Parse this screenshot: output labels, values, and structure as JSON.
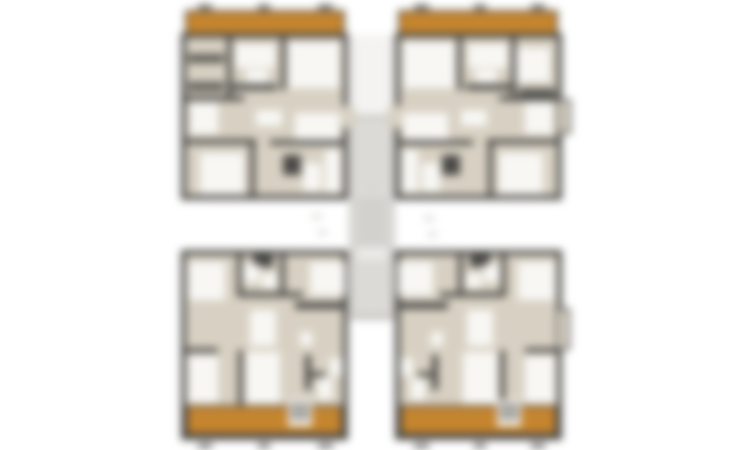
{
  "meta": {
    "description": "Blurred architectural floor plan: four apartment units around a central stair core, orange balconies on outer edges"
  },
  "floorplan": {
    "canvas": {
      "width": 750,
      "height": 450,
      "background": "#ffffff"
    },
    "palette": {
      "wall": "#4a4946",
      "floor": "#d8d1c3",
      "room": "#f8f7f4",
      "balcony": "#c5852f",
      "core": "#dcdad6",
      "coreLine": "#c3c1bd",
      "furn": "#5f5d58",
      "faint": "#e3e1de"
    },
    "shapes": [
      [
        350,
        35,
        44,
        80,
        "#f4f3f1",
        "corridor-upper",
        0
      ],
      [
        352,
        35,
        2,
        80,
        "faint",
        "corridor-wall-line",
        0
      ],
      [
        390,
        35,
        2,
        80,
        "faint",
        "corridor-wall-line",
        0
      ],
      [
        349,
        115,
        46,
        205,
        "core",
        "stair-core",
        0
      ],
      [
        352,
        115,
        40,
        3,
        "coreLine",
        "core-edge",
        0
      ],
      [
        351,
        118,
        2,
        198,
        "coreLine",
        "core-edge",
        0
      ],
      [
        391,
        118,
        2,
        198,
        "coreLine",
        "core-edge",
        0
      ],
      [
        358,
        200,
        28,
        3,
        "coreLine",
        "stair-tread",
        0
      ],
      [
        358,
        208,
        28,
        3,
        "coreLine",
        "stair-tread",
        0
      ],
      [
        358,
        216,
        28,
        3,
        "coreLine",
        "stair-tread",
        0
      ],
      [
        358,
        224,
        28,
        3,
        "coreLine",
        "stair-tread",
        0
      ],
      [
        358,
        232,
        28,
        3,
        "coreLine",
        "stair-tread",
        0
      ],
      [
        358,
        240,
        28,
        3,
        "coreLine",
        "stair-tread",
        0
      ],
      [
        357,
        248,
        30,
        12,
        "#eceae7",
        "stair-landing",
        0
      ],
      [
        352,
        316,
        40,
        3,
        "#b3b1ad",
        "core-edge",
        0
      ],
      [
        312,
        214,
        10,
        5,
        "#dddbd8",
        "faint-annotation",
        0
      ],
      [
        318,
        230,
        9,
        5,
        "#dddbd8",
        "faint-annotation",
        0
      ],
      [
        424,
        216,
        10,
        5,
        "#dddbd8",
        "faint-annotation",
        0
      ],
      [
        428,
        232,
        9,
        5,
        "#dddbd8",
        "faint-annotation",
        0
      ],
      [
        366,
        184,
        12,
        5,
        "#d6d4d1",
        "faint-annotation",
        0
      ],
      [
        198,
        5,
        14,
        4,
        "wall",
        "dimension-tick",
        0
      ],
      [
        258,
        5,
        12,
        4,
        "wall",
        "dimension-tick",
        0
      ],
      [
        318,
        5,
        15,
        4,
        "wall",
        "dimension-tick",
        0
      ],
      [
        185,
        10,
        160,
        25,
        "balcony",
        "balcony-top-left",
        1
      ],
      [
        181,
        33,
        167,
        167,
        "wall",
        "unit-a-outline",
        0
      ],
      [
        186,
        38,
        157,
        157,
        "floor",
        "unit-a-floor",
        0
      ],
      [
        227,
        38,
        5,
        60,
        "wall",
        "wall-segment",
        0
      ],
      [
        188,
        54,
        36,
        9,
        "furn",
        "furniture",
        0
      ],
      [
        188,
        82,
        36,
        9,
        "furn",
        "furniture",
        0
      ],
      [
        235,
        44,
        40,
        24,
        "room",
        "room-area",
        0
      ],
      [
        246,
        70,
        22,
        13,
        "room",
        "room-area",
        0
      ],
      [
        281,
        38,
        5,
        52,
        "wall",
        "wall-segment",
        0
      ],
      [
        227,
        84,
        50,
        6,
        "wall",
        "wall-segment",
        0
      ],
      [
        288,
        42,
        52,
        46,
        "room",
        "room-area",
        0
      ],
      [
        186,
        96,
        58,
        5,
        "wall",
        "wall-segment",
        0
      ],
      [
        190,
        102,
        28,
        32,
        "room",
        "room-area",
        0
      ],
      [
        256,
        110,
        26,
        16,
        "room",
        "room-area",
        0
      ],
      [
        295,
        113,
        45,
        32,
        "room",
        "room-area",
        0
      ],
      [
        186,
        139,
        70,
        5,
        "wall",
        "wall-segment",
        0
      ],
      [
        270,
        140,
        73,
        5,
        "wall",
        "wall-segment",
        0
      ],
      [
        250,
        144,
        5,
        51,
        "wall",
        "wall-segment",
        0
      ],
      [
        200,
        153,
        44,
        41,
        "room",
        "room-area",
        0
      ],
      [
        283,
        155,
        18,
        20,
        "wall",
        "wall-segment",
        0
      ],
      [
        303,
        163,
        18,
        28,
        "room",
        "room-area",
        0
      ],
      [
        325,
        150,
        16,
        42,
        "room",
        "room-area",
        0
      ],
      [
        343,
        106,
        12,
        22,
        "floor",
        "door-opening",
        0
      ],
      [
        414,
        5,
        15,
        4,
        "wall",
        "dimension-tick",
        0
      ],
      [
        474,
        5,
        12,
        4,
        "wall",
        "dimension-tick",
        0
      ],
      [
        531,
        5,
        14,
        4,
        "wall",
        "dimension-tick",
        0
      ],
      [
        398,
        10,
        160,
        25,
        "balcony",
        "balcony-top-right",
        1
      ],
      [
        395,
        33,
        167,
        167,
        "wall",
        "unit-b-outline",
        0
      ],
      [
        400,
        38,
        157,
        157,
        "floor",
        "unit-b-floor",
        0
      ],
      [
        557,
        99,
        14,
        35,
        "floor",
        "bay-window",
        1
      ],
      [
        511,
        38,
        5,
        60,
        "wall",
        "wall-segment",
        0
      ],
      [
        516,
        48,
        34,
        34,
        "room",
        "room-area",
        0
      ],
      [
        519,
        88,
        36,
        8,
        "furn",
        "furniture",
        0
      ],
      [
        468,
        44,
        40,
        24,
        "room",
        "room-area",
        0
      ],
      [
        475,
        70,
        22,
        13,
        "room",
        "room-area",
        0
      ],
      [
        457,
        38,
        5,
        52,
        "wall",
        "wall-segment",
        0
      ],
      [
        466,
        84,
        50,
        6,
        "wall",
        "wall-segment",
        0
      ],
      [
        403,
        42,
        52,
        46,
        "room",
        "room-area",
        0
      ],
      [
        499,
        96,
        58,
        5,
        "wall",
        "wall-segment",
        0
      ],
      [
        525,
        102,
        28,
        32,
        "room",
        "room-area",
        0
      ],
      [
        461,
        110,
        26,
        16,
        "room",
        "room-area",
        0
      ],
      [
        403,
        113,
        45,
        32,
        "room",
        "room-area",
        0
      ],
      [
        487,
        139,
        70,
        5,
        "wall",
        "wall-segment",
        0
      ],
      [
        400,
        140,
        73,
        5,
        "wall",
        "wall-segment",
        0
      ],
      [
        488,
        144,
        5,
        51,
        "wall",
        "wall-segment",
        0
      ],
      [
        499,
        153,
        44,
        41,
        "room",
        "room-area",
        0
      ],
      [
        442,
        155,
        18,
        20,
        "wall",
        "wall-segment",
        0
      ],
      [
        422,
        163,
        18,
        28,
        "room",
        "room-area",
        0
      ],
      [
        402,
        150,
        16,
        42,
        "room",
        "room-area",
        0
      ],
      [
        388,
        106,
        12,
        22,
        "floor",
        "door-opening",
        0
      ],
      [
        181,
        250,
        167,
        190,
        "wall",
        "unit-c-outline",
        0
      ],
      [
        186,
        255,
        157,
        150,
        "floor",
        "unit-c-floor",
        0
      ],
      [
        186,
        405,
        157,
        30,
        "balcony",
        "balcony-bottom-left",
        1
      ],
      [
        188,
        262,
        37,
        38,
        "room",
        "room-area",
        0
      ],
      [
        237,
        255,
        5,
        40,
        "wall",
        "wall-segment",
        0
      ],
      [
        280,
        255,
        5,
        40,
        "wall",
        "wall-segment",
        0
      ],
      [
        253,
        255,
        20,
        12,
        "wall",
        "wall-segment",
        0
      ],
      [
        243,
        264,
        16,
        18,
        "room",
        "room-area",
        0
      ],
      [
        262,
        273,
        15,
        15,
        "room",
        "room-area",
        0
      ],
      [
        237,
        292,
        66,
        5,
        "wall",
        "wall-segment",
        0
      ],
      [
        310,
        262,
        35,
        33,
        "room",
        "room-area",
        0
      ],
      [
        295,
        302,
        50,
        7,
        "wall",
        "wall-segment",
        0
      ],
      [
        250,
        310,
        26,
        36,
        "room",
        "room-area",
        0
      ],
      [
        300,
        332,
        12,
        14,
        "room",
        "room-area",
        0
      ],
      [
        186,
        348,
        32,
        5,
        "wall",
        "wall-segment",
        0
      ],
      [
        238,
        350,
        5,
        55,
        "wall",
        "wall-segment",
        0
      ],
      [
        188,
        355,
        30,
        48,
        "room",
        "room-area",
        0
      ],
      [
        246,
        352,
        34,
        52,
        "room",
        "room-area",
        0
      ],
      [
        305,
        355,
        6,
        35,
        "wall",
        "wall-segment",
        0
      ],
      [
        311,
        372,
        14,
        5,
        "wall",
        "wall-segment",
        0
      ],
      [
        318,
        378,
        14,
        22,
        "room",
        "room-area",
        0
      ],
      [
        330,
        358,
        13,
        18,
        "room",
        "room-area",
        0
      ],
      [
        288,
        400,
        24,
        26,
        "room",
        "balcony-steps",
        0
      ],
      [
        290,
        404,
        20,
        3,
        "furn",
        "step-tread",
        0
      ],
      [
        290,
        410,
        20,
        3,
        "furn",
        "step-tread",
        0
      ],
      [
        290,
        416,
        20,
        3,
        "furn",
        "step-tread",
        0
      ],
      [
        198,
        444,
        14,
        4,
        "wall",
        "dimension-tick",
        0
      ],
      [
        258,
        444,
        12,
        4,
        "wall",
        "dimension-tick",
        0
      ],
      [
        318,
        444,
        15,
        4,
        "wall",
        "dimension-tick",
        0
      ],
      [
        395,
        250,
        167,
        190,
        "wall",
        "unit-d-outline",
        0
      ],
      [
        400,
        255,
        157,
        150,
        "floor",
        "unit-d-floor",
        0
      ],
      [
        400,
        405,
        157,
        30,
        "balcony",
        "balcony-bottom-right",
        1
      ],
      [
        556,
        308,
        14,
        42,
        "floor",
        "bay-window",
        1
      ],
      [
        518,
        262,
        37,
        38,
        "room",
        "room-area",
        0
      ],
      [
        501,
        255,
        5,
        40,
        "wall",
        "wall-segment",
        0
      ],
      [
        458,
        255,
        5,
        40,
        "wall",
        "wall-segment",
        0
      ],
      [
        470,
        255,
        20,
        12,
        "wall",
        "wall-segment",
        0
      ],
      [
        484,
        264,
        16,
        18,
        "room",
        "room-area",
        0
      ],
      [
        466,
        273,
        15,
        15,
        "room",
        "room-area",
        0
      ],
      [
        440,
        292,
        66,
        5,
        "wall",
        "wall-segment",
        0
      ],
      [
        398,
        262,
        35,
        33,
        "room",
        "room-area",
        0
      ],
      [
        398,
        302,
        50,
        7,
        "wall",
        "wall-segment",
        0
      ],
      [
        467,
        310,
        26,
        36,
        "room",
        "room-area",
        0
      ],
      [
        431,
        332,
        12,
        14,
        "room",
        "room-area",
        0
      ],
      [
        525,
        348,
        32,
        5,
        "wall",
        "wall-segment",
        0
      ],
      [
        500,
        350,
        5,
        55,
        "wall",
        "wall-segment",
        0
      ],
      [
        525,
        355,
        30,
        48,
        "room",
        "room-area",
        0
      ],
      [
        463,
        352,
        34,
        52,
        "room",
        "room-area",
        0
      ],
      [
        432,
        355,
        6,
        35,
        "wall",
        "wall-segment",
        0
      ],
      [
        418,
        372,
        14,
        5,
        "wall",
        "wall-segment",
        0
      ],
      [
        411,
        378,
        14,
        22,
        "room",
        "room-area",
        0
      ],
      [
        400,
        358,
        13,
        18,
        "room",
        "room-area",
        0
      ],
      [
        497,
        400,
        24,
        26,
        "room",
        "balcony-steps",
        0
      ],
      [
        499,
        404,
        20,
        3,
        "furn",
        "step-tread",
        0
      ],
      [
        499,
        410,
        20,
        3,
        "furn",
        "step-tread",
        0
      ],
      [
        499,
        416,
        20,
        3,
        "furn",
        "step-tread",
        0
      ],
      [
        414,
        444,
        15,
        4,
        "wall",
        "dimension-tick",
        0
      ],
      [
        474,
        444,
        12,
        4,
        "wall",
        "dimension-tick",
        0
      ],
      [
        531,
        444,
        14,
        4,
        "wall",
        "dimension-tick",
        0
      ]
    ]
  }
}
